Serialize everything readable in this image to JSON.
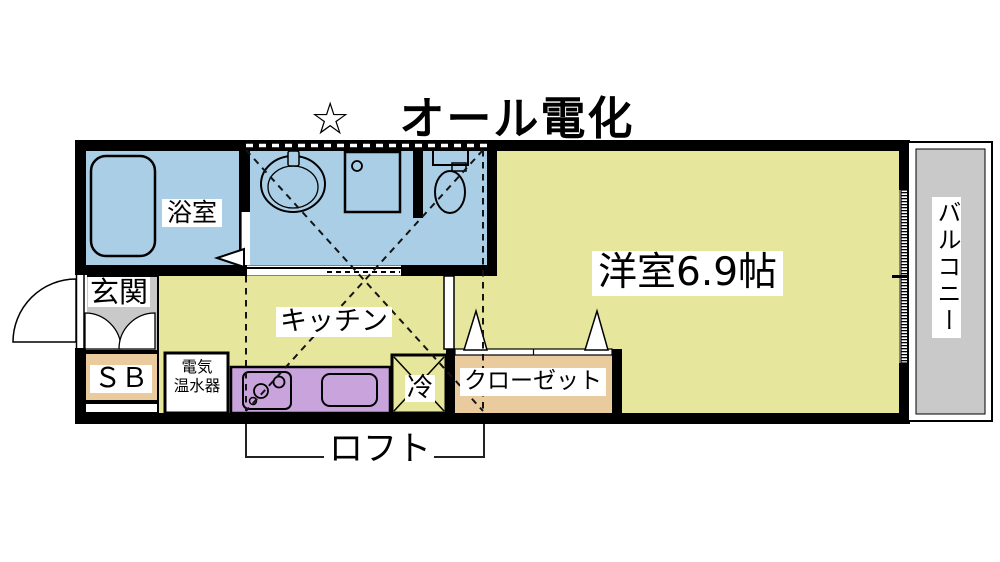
{
  "title": "☆　オール電化",
  "labels": {
    "bathroom": "浴室",
    "entrance": "玄関",
    "shoe_box": "ＳＢ",
    "water_heater": [
      "電気",
      "温水器"
    ],
    "kitchen": "キッチン",
    "fridge": "冷",
    "closet": "クローゼット",
    "main_room": "洋室6.9帖",
    "balcony": "バルコニー",
    "loft": "ロフト"
  },
  "colors": {
    "wet": "#a9cee6",
    "room": "#e6e69c",
    "entry": "#c9c9c9",
    "storage": "#e9cb9e",
    "counter": "#c9a3dc",
    "wall": "#000000"
  }
}
